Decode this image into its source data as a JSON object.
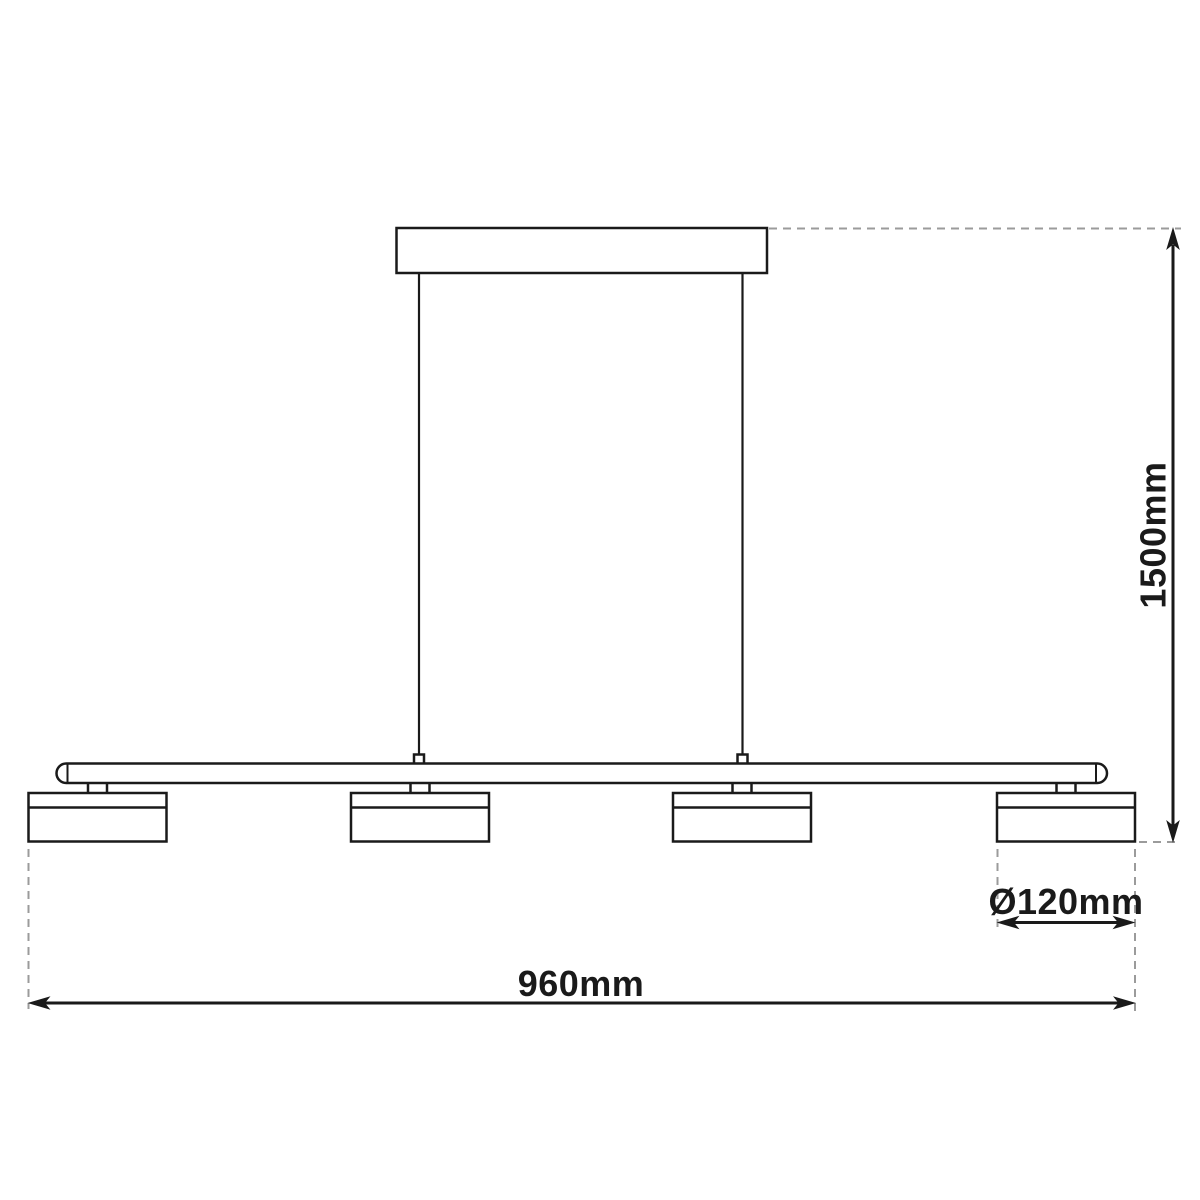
{
  "drawing": {
    "name": "pendant-lamp-dimension-diagram",
    "lamp_head_count": 4,
    "labels": {
      "height": "1500mm",
      "width": "960mm",
      "diameter": "Ø120mm"
    },
    "colors": {
      "line": "#1a1a1a",
      "dashed": "#9b9b9b",
      "text": "#1a1a1a",
      "background": "#ffffff"
    }
  }
}
